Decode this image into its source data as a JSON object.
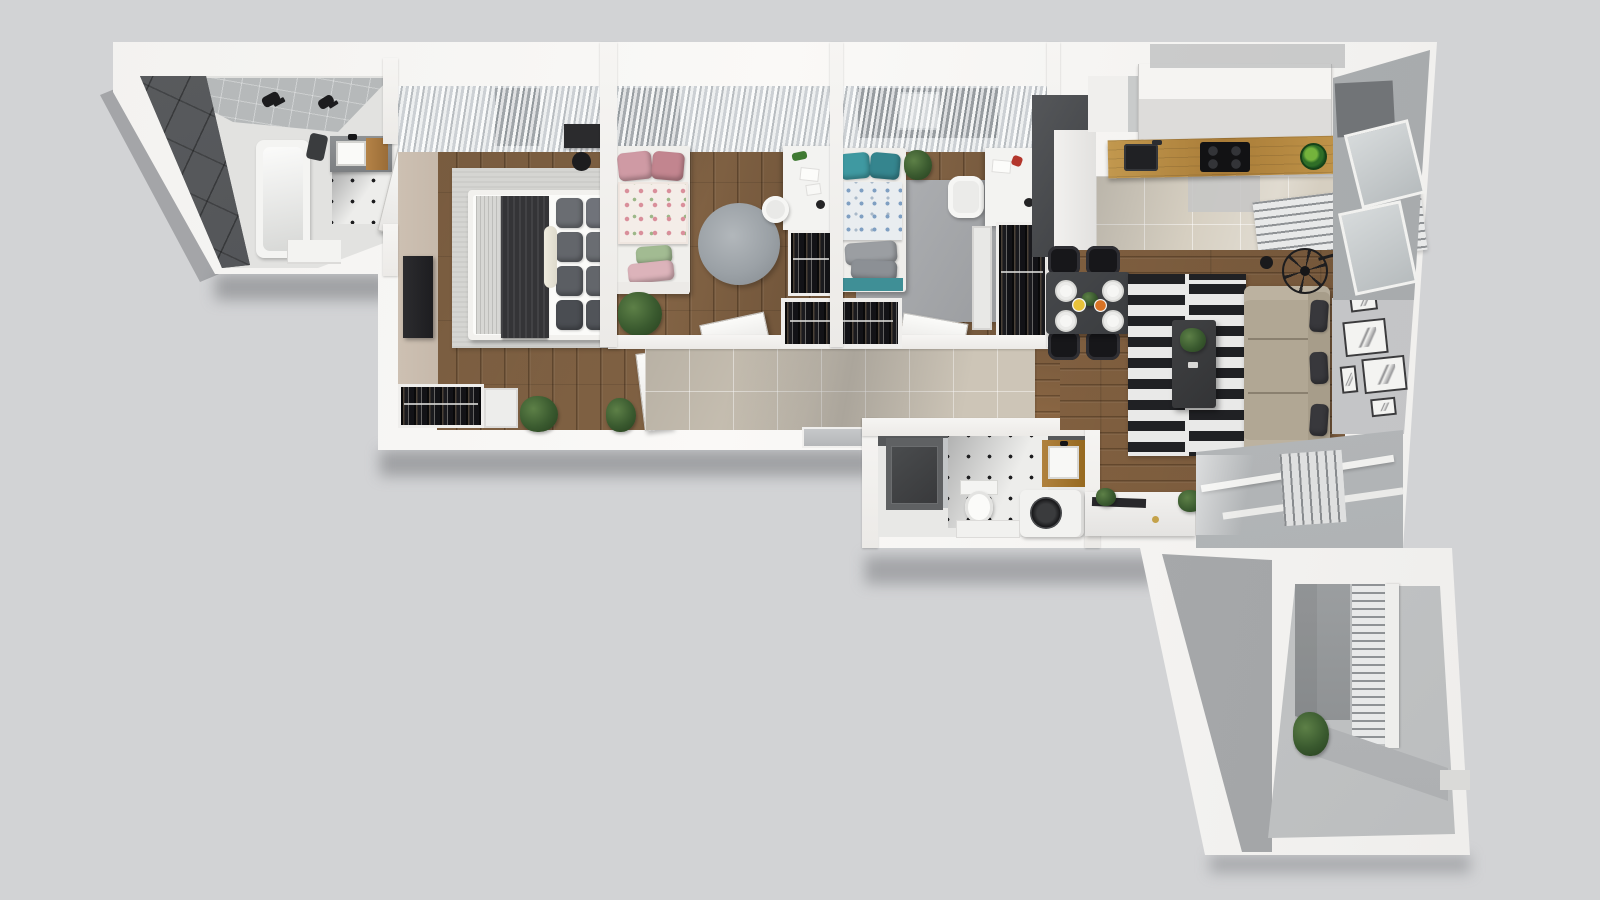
{
  "title": "apartment-3d-floor-plan-render",
  "view": "top-down-axonometric",
  "background": "#d2d3d5",
  "palette": {
    "bg": "#d2d3d5",
    "wall": "#f4f3f1",
    "wallshade": "#e7e6e4",
    "wood": "#7c5e42",
    "woodlive": "#84603f",
    "counter": "#b5873f",
    "tilehall": "#cdc5b7",
    "tilekitchen": "#d6cfc1",
    "darktile": "#4b4d50",
    "ruggray": "#d5d5d2",
    "ruground": "#9ba1a6",
    "stripedark": "#202124",
    "stripelight": "#e9e9e8",
    "sofa": "#b1a794",
    "pillowdark": "#38383c",
    "blanketdark": "#343437",
    "pink": "#cf9aa4",
    "teal": "#3f99a1",
    "plantgreen": "#3a5a2f",
    "black": "#17171a",
    "glassgray": "#c9cdce",
    "curtain": "#d3d6d8",
    "balconyfloor": "#c5c7c8",
    "concrete": "#97999b",
    "beigewall": "#c6b9ab"
  },
  "rooms": [
    {
      "name": "main-bathroom",
      "items": [
        "dark-tile-wall",
        "gray-tile-strip",
        "bathtub",
        "shower-fixtures",
        "vanity-sink",
        "dot-tile-floor",
        "low-bench",
        "door"
      ]
    },
    {
      "name": "master-bedroom",
      "items": [
        "sheer-curtain-window",
        "tv-panel",
        "area-rug",
        "double-bed",
        "gray-pillows",
        "dark-throw",
        "dressing-desk",
        "stool",
        "open-wardrobe",
        "dresser",
        "potted-plants",
        "door"
      ]
    },
    {
      "name": "kids-room-left",
      "items": [
        "sheer-curtain-window",
        "single-bed-pink-floral",
        "round-rug",
        "desk",
        "stool",
        "open-wardrobe",
        "potted-plant",
        "door"
      ]
    },
    {
      "name": "kids-room-right",
      "items": [
        "sheer-curtain-window",
        "single-bed-teal",
        "area-rug",
        "desk",
        "chair",
        "drawer-unit",
        "open-wardrobe",
        "potted-plant",
        "door"
      ]
    },
    {
      "name": "hallway",
      "items": [
        "beige-tile-floor",
        "built-in-wardrobe",
        "open-doors",
        "entry-door"
      ]
    },
    {
      "name": "second-bathroom",
      "items": [
        "walk-in-shower",
        "toilet",
        "dot-tile-floor",
        "vanity-sink",
        "washing-machine",
        "low-cabinet"
      ]
    },
    {
      "name": "kitchen",
      "items": [
        "upper-cabinets",
        "wood-countertop",
        "sink",
        "cooktop",
        "fruit-bowl",
        "tall-dark-unit",
        "tile-floor",
        "radiator"
      ]
    },
    {
      "name": "living-dining-area",
      "items": [
        "dining-table",
        "black-chairs",
        "place-settings",
        "striped-rug",
        "coffee-table",
        "plant",
        "sofa",
        "accent-pillows",
        "pendant-fan-lamp",
        "gallery-wall-frames",
        "tv-sideboard",
        "window-wall",
        "radiator"
      ]
    },
    {
      "name": "balcony",
      "items": [
        "railing",
        "concrete-panel",
        "bench",
        "potted-plant"
      ]
    }
  ]
}
